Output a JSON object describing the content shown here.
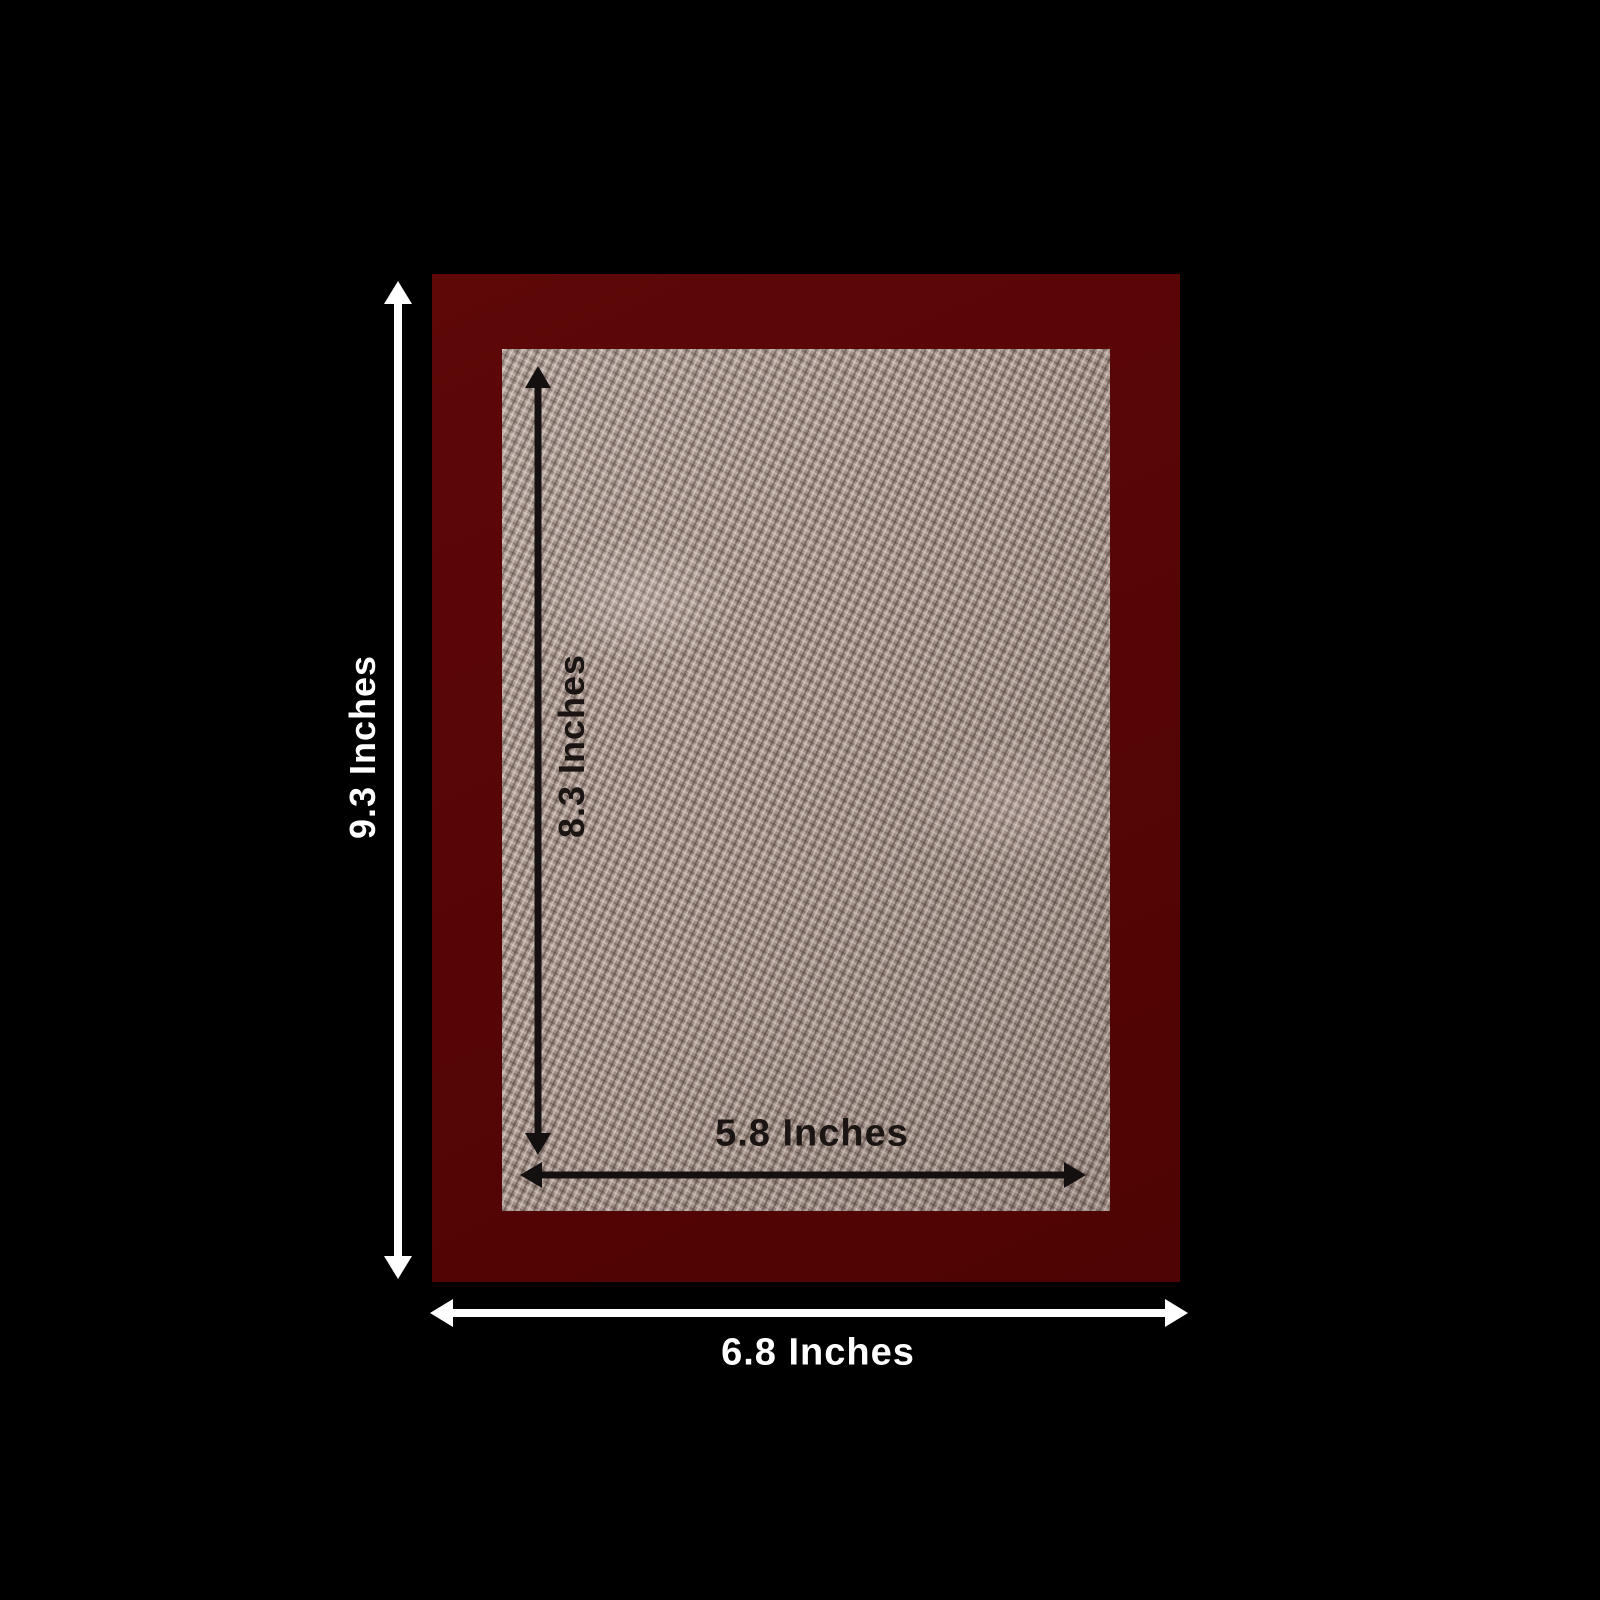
{
  "diagram": {
    "description": "Product dimension diagram: maroon-bordered woven fabric mat on black background",
    "labels": {
      "outer_height": "9.3 Inches",
      "inner_height": "8.3 Inches",
      "inner_width": "5.8 Inches",
      "outer_width": "6.8 Inches"
    },
    "colors": {
      "background": "#000000",
      "frame": "#570505",
      "mat": "#a4938b",
      "outer_arrow": "#ffffff",
      "inner_arrow": "#141010",
      "outer_label": "#ffffff",
      "inner_label": "#1a1512"
    }
  }
}
